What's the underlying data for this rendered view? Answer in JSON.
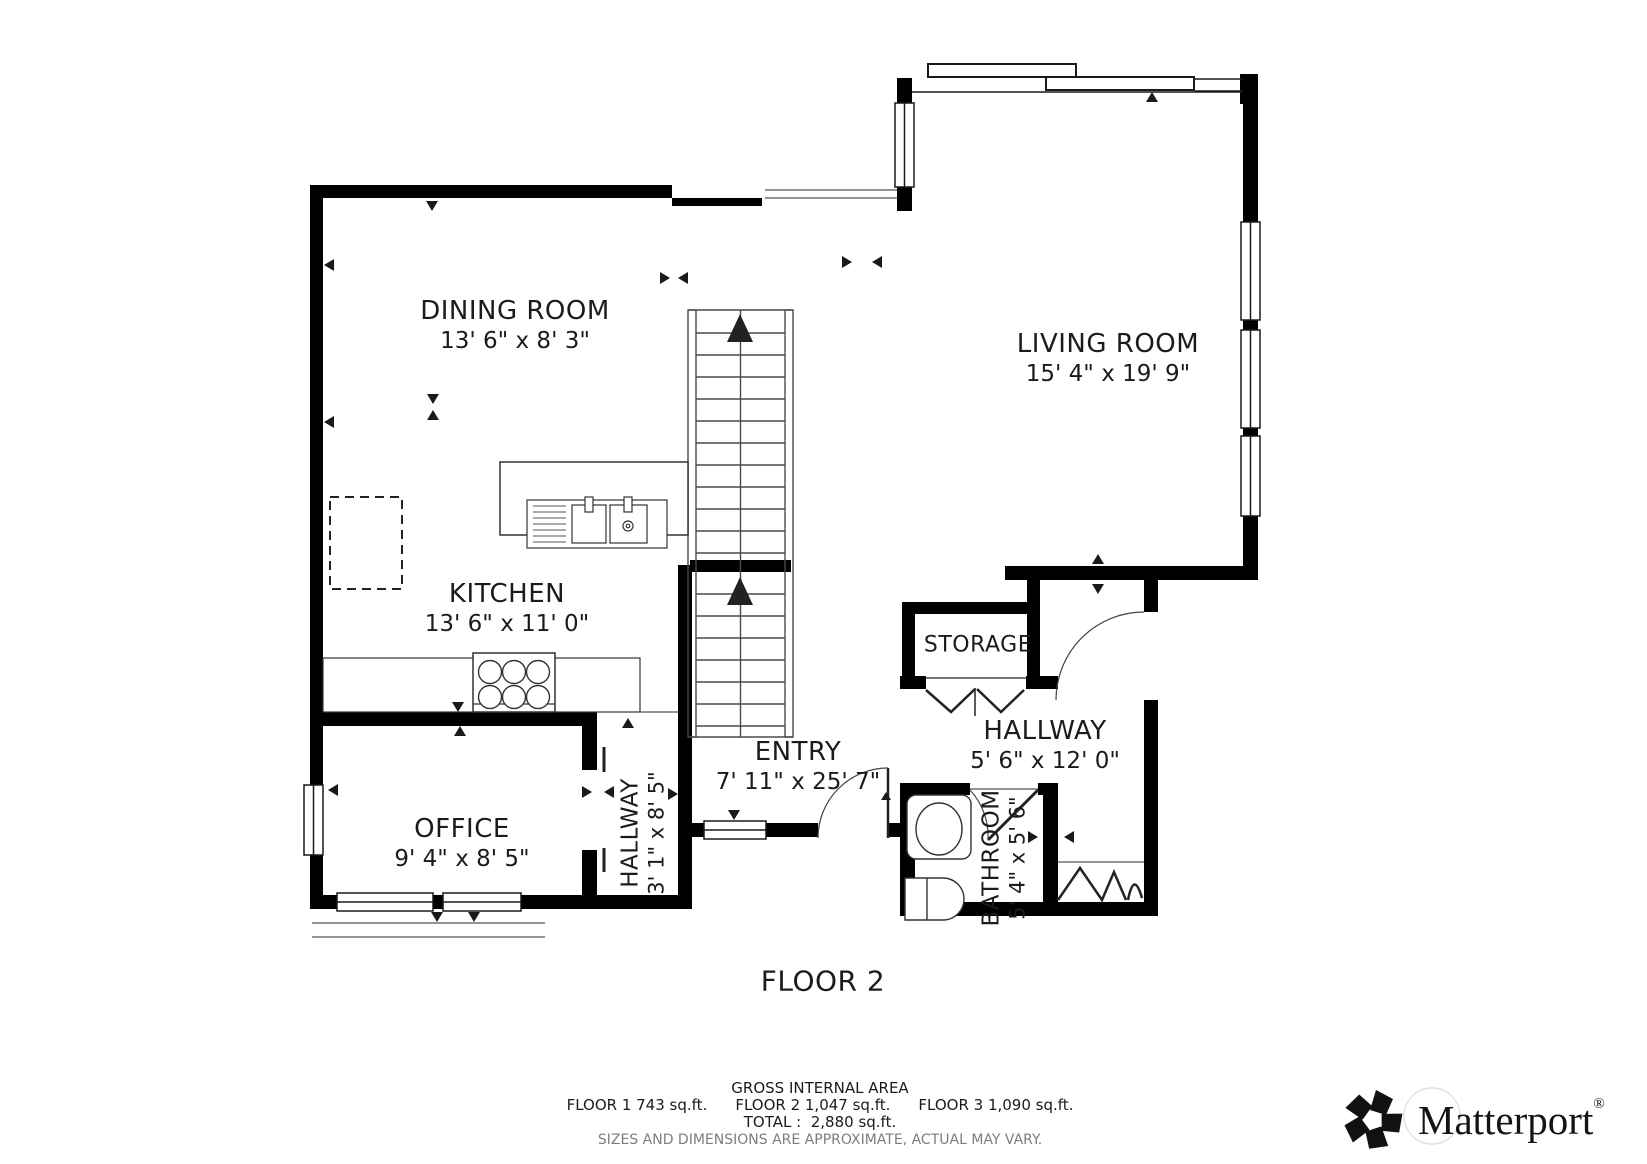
{
  "floor_plan": {
    "title": "FLOOR 2",
    "rooms": [
      {
        "name": "DINING ROOM",
        "dims": "13' 6\" x 8' 3\""
      },
      {
        "name": "LIVING ROOM",
        "dims": "15' 4\" x 19' 9\""
      },
      {
        "name": "KITCHEN",
        "dims": "13' 6\" x 11' 0\""
      },
      {
        "name": "OFFICE",
        "dims": "9' 4\" x 8' 5\""
      },
      {
        "name": "ENTRY",
        "dims": "7' 11\" x 25' 7\""
      },
      {
        "name": "HALLWAY",
        "dims": "5' 6\" x 12' 0\""
      },
      {
        "name": "HALLWAY",
        "dims": "3' 1\" x 8' 5\""
      },
      {
        "name": "BATHROOM",
        "dims": "5' 4\" x 5' 6\""
      },
      {
        "name": "STORAGE",
        "dims": ""
      }
    ]
  },
  "footer": {
    "gross_area_label": "GROSS INTERNAL AREA",
    "floor1": "FLOOR 1 743 sq.ft.",
    "floor2": "FLOOR 2 1,047 sq.ft.",
    "floor3": "FLOOR 3 1,090 sq.ft.",
    "total_label": "TOTAL :",
    "total_value": "2,880 sq.ft.",
    "disclaimer": "SIZES AND DIMENSIONS ARE APPROXIMATE, ACTUAL MAY VARY.",
    "brand": "Matterport",
    "registered": "®"
  },
  "colors": {
    "wall": "#000000",
    "fixture_line": "#4a4a4a",
    "disclaimer_text": "#7d7d7d"
  }
}
